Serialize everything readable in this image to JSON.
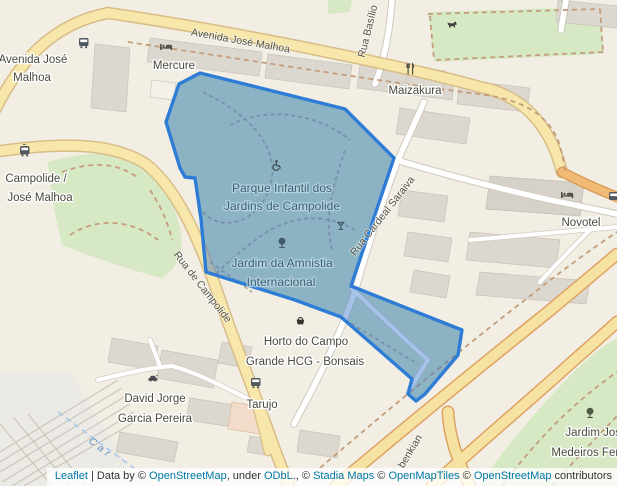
{
  "colors": {
    "land": "#f2eee3",
    "building": "#dcd7cf",
    "green": "#d7e8c5",
    "road_yellow": "#f8e7ab",
    "road_orange": "#f1bb76",
    "overlay_stroke": "#2e7cd6",
    "overlay_fill": "rgba(45,110,200,0.42)",
    "link_blue": "#0078A8"
  },
  "labels": {
    "av_malhoa_street": "Avenida José Malhoa",
    "av_malhoa_stop1": "Avenida José",
    "av_malhoa_stop2": "Malhoa",
    "mercure": "Mercure",
    "rua_basilio": "Rua Basílio",
    "maizakura": "Maizakura",
    "campolide_stn1": "Campolide /",
    "campolide_stn2": "José Malhoa",
    "park1": "Parque Infantil dos",
    "park2": "Jardins de Campolide",
    "amnistia1": "Jardim da Amnistia",
    "amnistia2": "Internacional",
    "rua_campolide": "Rua de Campolide",
    "rua_saraiva": "Rua Cardeal Saraiva",
    "novotel": "Novotel",
    "horto1": "Horto do Campo",
    "horto2": "Grande HCG - Bonsais",
    "david1": "David Jorge",
    "david2": "Garcia Pereira",
    "tarujo": "Tarujo",
    "jardim_jose1": "Jardim Jos",
    "jardim_jose2": "Medeiros Ferr",
    "gulbenkian": "benkian",
    "boundary": "Car"
  },
  "attribution": {
    "leaflet": "Leaflet",
    "sep": " | Data by © ",
    "osm1": "OpenStreetMap",
    "under": ", under ",
    "odbl": "ODbL",
    "dot": "., © ",
    "stadia": "Stadia Maps",
    "c2": " © ",
    "omt": "OpenMapTiles",
    "c3": " © ",
    "osm2": "OpenStreetMap",
    "contrib": " contributors"
  }
}
